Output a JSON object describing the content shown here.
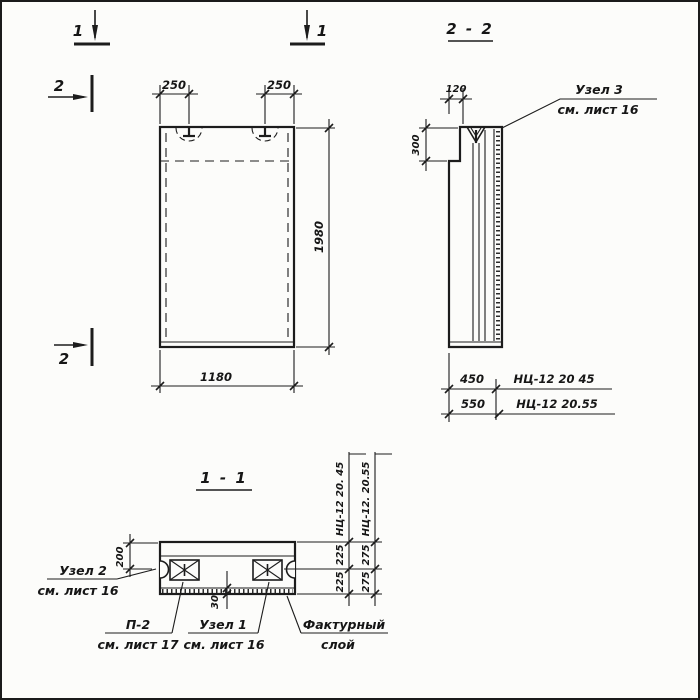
{
  "drawing_title": "Panel working drawing НЦ-12",
  "markers": {
    "sec1_left": "1",
    "sec1_right": "1",
    "sec2_top": "2",
    "sec2_bottom": "2"
  },
  "front_view": {
    "dim_loop_left": "250",
    "dim_loop_right": "250",
    "dim_height": "1980",
    "dim_width": "1180"
  },
  "section_2_2": {
    "title": "2 - 2",
    "dim_notch": "120",
    "dim_step": "300",
    "dim_width_45": "450",
    "mark_45": "НЦ-12 20 45",
    "dim_width_55": "550",
    "mark_55": "НЦ-12 20.55",
    "callout_node3": "Узел 3",
    "callout_node3_ref": "см. лист 16"
  },
  "section_1_1": {
    "title": "1 - 1",
    "dim_top": "200",
    "dim_facing": "30",
    "chain_45": {
      "label": "НЦ-12 20. 45",
      "upper": "225",
      "lower": "225"
    },
    "chain_55": {
      "label": "НЦ-12. 20.55",
      "upper": "275",
      "lower": "275"
    },
    "callout_node2": "Узел 2",
    "callout_node2_ref": "см. лист 16",
    "callout_p2": "П-2",
    "callout_p2_ref": "см. лист 17",
    "callout_node1": "Узел 1",
    "callout_node1_ref": "см. лист 16",
    "callout_facing_line1": "Фактурный",
    "callout_facing_line2": "слой"
  }
}
